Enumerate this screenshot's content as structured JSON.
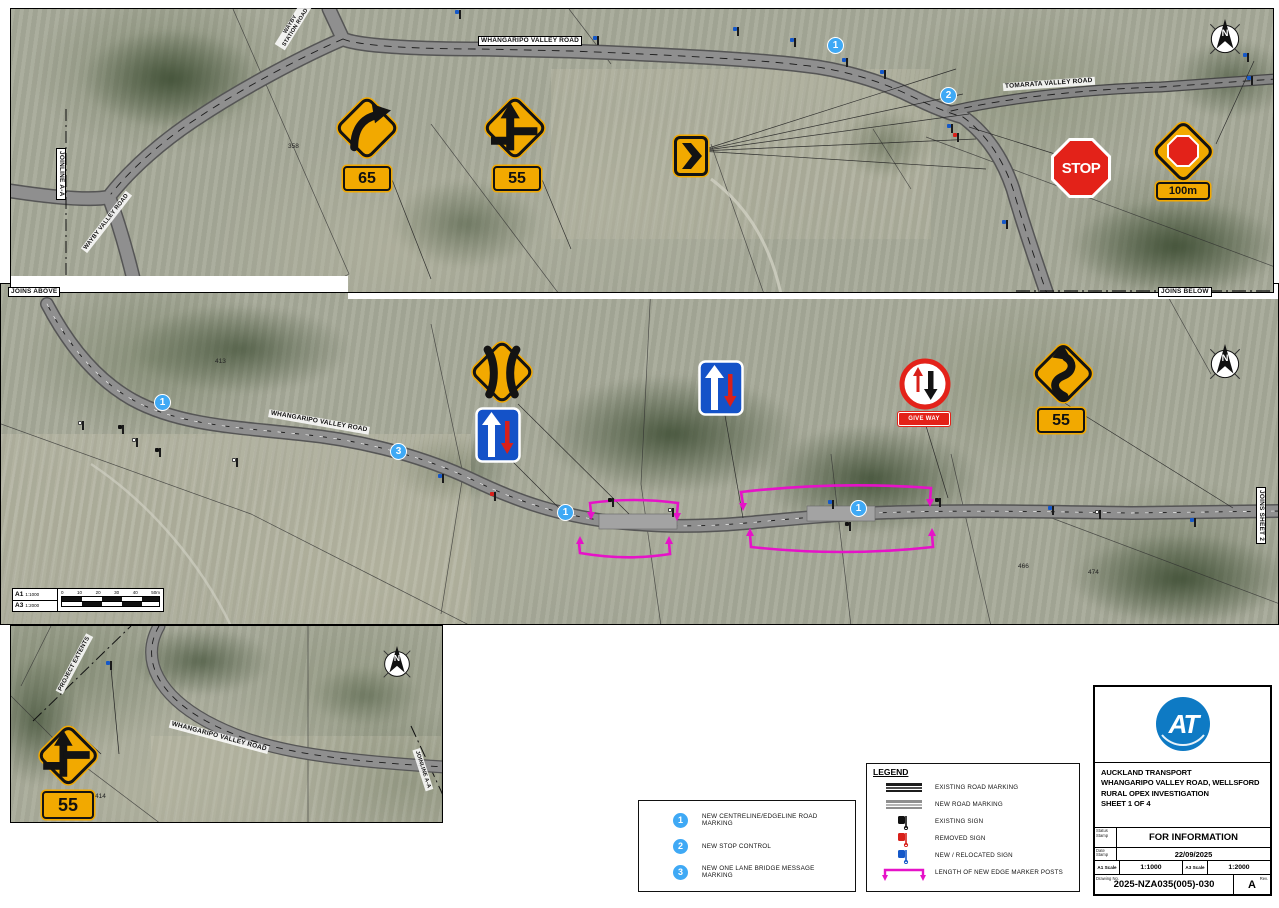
{
  "colors": {
    "sign_yellow": "#F2A900",
    "sign_red": "#E32219",
    "sign_blue": "#1452C8",
    "marker_blue": "#3FA9F5",
    "magenta": "#E612C8",
    "at_blue": "#0E7AC4"
  },
  "map": {
    "compass_n": "N",
    "road_labels": {
      "whangaripo_top": "WHANGARIPO VALLEY ROAD",
      "tomarata": "TOMARATA VALLEY ROAD",
      "wayby_station": "WAYBY STATION ROAD",
      "wayby_valley": "WAYBY VALLEY ROAD",
      "whangaripo_mid": "WHANGARIPO VALLEY ROAD",
      "whangaripo_inset": "WHANGARIPO VALLEY ROAD"
    },
    "match_labels": {
      "joinline_top": "JOINLINE A-A",
      "joins_above": "JOINS ABOVE",
      "joins_below": "JOINS BELOW",
      "joins_sheet2": "JOINS SHEET 2",
      "project_extents": "PROJECT EXTENTS",
      "joinline_inset": "JOINLINE A-A"
    },
    "parcels": {
      "p358": "358",
      "p413": "413",
      "p414": "414",
      "p466": "466",
      "p474": "474"
    },
    "markers": {
      "m1": "1",
      "m2": "2",
      "m3": "3"
    },
    "signs": {
      "stop_text": "STOP",
      "give_way_text": "GIVE WAY",
      "plate_65": "65",
      "plate_55": "55",
      "plate_100m": "100m"
    }
  },
  "scalebar": {
    "a1": "A1",
    "a1_scale": "1:1000",
    "a3": "A3",
    "a3_scale": "1:2000",
    "ticks": [
      "0",
      "10",
      "20",
      "30",
      "40",
      "50m"
    ]
  },
  "notes": {
    "items": [
      {
        "num": "1",
        "text": "NEW CENTRELINE/EDGELINE ROAD MARKING"
      },
      {
        "num": "2",
        "text": "NEW STOP CONTROL"
      },
      {
        "num": "3",
        "text": "NEW ONE LANE BRIDGE MESSAGE MARKING"
      }
    ]
  },
  "legend": {
    "title": "LEGEND",
    "items": [
      {
        "label": "EXISTING ROAD MARKING"
      },
      {
        "label": "NEW ROAD MARKING"
      },
      {
        "label": "EXISTING SIGN"
      },
      {
        "label": "REMOVED SIGN"
      },
      {
        "label": "NEW / RELOCATED SIGN"
      },
      {
        "label": "LENGTH OF NEW EDGE MARKER POSTS"
      }
    ]
  },
  "titleblock": {
    "logo": "AT",
    "company": "AUCKLAND TRANSPORT",
    "project": "WHANGARIPO VALLEY ROAD, WELLSFORD",
    "subtitle": "RURAL OPEX INVESTIGATION",
    "sheet": "SHEET 1 OF 4",
    "status_label": "Status Stamp",
    "status": "FOR INFORMATION",
    "date_label": "Date Stamp",
    "date": "22/09/2025",
    "a1_scale_label": "A1 Scale",
    "a1_scale": "1:1000",
    "a3_scale_label": "A3 Scale",
    "a3_scale": "1:2000",
    "drawing_no_label": "Drawing No.",
    "drawing_no": "2025-NZA035(005)-030",
    "rev_label": "Rev.",
    "rev": "A"
  }
}
